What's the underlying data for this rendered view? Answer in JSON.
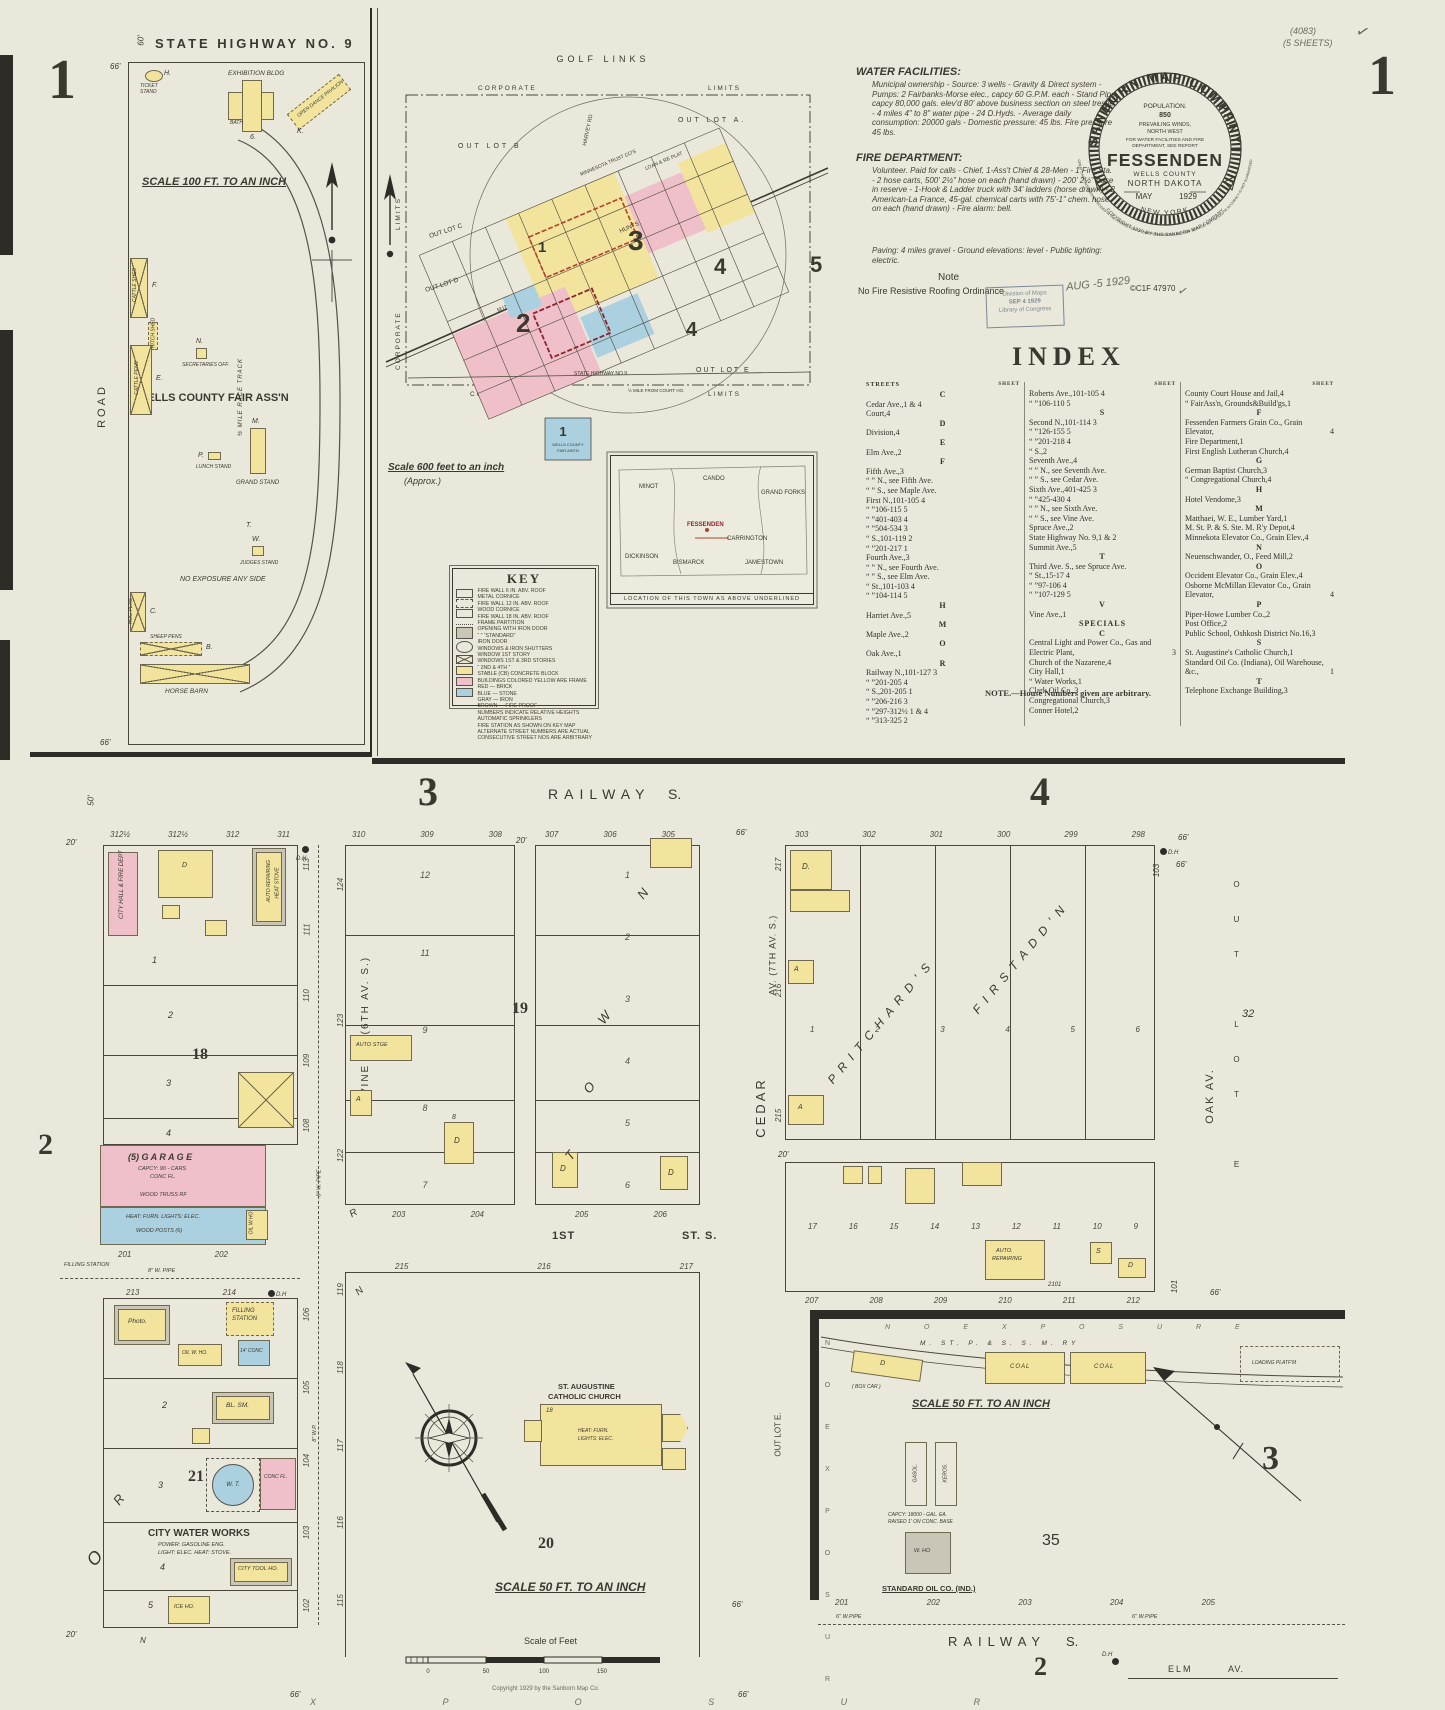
{
  "page": {
    "corner_left": "1",
    "corner_right": "1",
    "series": "(4083)",
    "sheets": "(5 SHEETS)",
    "check": "✓"
  },
  "report": {
    "water_title": "WATER FACILITIES:",
    "water_body": "Municipal ownership - Source: 3 wells - Gravity & Direct system - Pumps: 2 Fairbanks-Morse elec., capcy 60 G.P.M. each - Stand Pipe capcy 80,000 gals. elev'd 80' above business section on steel trestle - 4 miles 4\" to 8\" water pipe - 24 D.Hyds. - Average daily consumption: 20000 gals - Domestic pressure: 45 lbs. Fire pressure 45 lbs.",
    "fire_title": "FIRE DEPARTMENT:",
    "fire_body": "Volunteer. Paid for calls - Chief, 1-Ass't Chief & 28-Men - 1 Fire Sta. - 2 hose carts, 500' 2½\" hose on each (hand drawn) - 200' 2½\" hose in reserve - 1-Hook & Ladder truck with 34' ladders (horse drawn) - 2 American-La France, 45-gal. chemical carts with 75'-1\" chem. hose on each (hand drawn) - Fire alarm: bell.",
    "paving": "Paving: 4 miles gravel - Ground elevations: level - Public lighting: electric.",
    "note_title": "Note",
    "note_body": "No Fire Resistive Roofing Ordinance"
  },
  "seal": {
    "company": "SANBORN MAP COMPANY",
    "population": "POPULATION.",
    "pop_value": "850",
    "winds1": "PREVAILING WINDS,",
    "winds2": "NORTH WEST",
    "report1": "FOR WATER FACILITIES AND FIRE",
    "report2": "DEPARTMENT, SEE REPORT",
    "city": "FESSENDEN",
    "county": "WELLS COUNTY",
    "state": "NORTH DAKOTA",
    "month": "MAY",
    "year": "1929",
    "office": "NEW YORK",
    "copyright": "COPYRIGHT 1929 BY THE SANBORN MAP COMPANY",
    "disclaimer": "GREAT CARE HAS BEEN EXERCISED IN THE PRODUCTION OF OUR PUBLICATIONS AND OUR SERVICE, BUT ABSOLUTE ACCURACY IS NOT GUARANTEED"
  },
  "stamps": {
    "received": "AUG -5 1929",
    "loc1": "Division of Maps",
    "loc2": "SEP 4 1929",
    "loc3": "Library of Congress",
    "catalog": "©C1F  47970",
    "check": "✓"
  },
  "index": {
    "title": "INDEX",
    "streets": "STREETS",
    "sheet": "SHEET",
    "footnote": "NOTE.—House Numbers given are arbitrary.",
    "col1": [
      {
        "h": "C"
      },
      {
        "n": "Cedar Ave.,",
        "r": "1 & 4"
      },
      {
        "n": "Court,",
        "r": "4"
      },
      {
        "h": "D"
      },
      {
        "n": "Division,",
        "r": "4"
      },
      {
        "h": "E"
      },
      {
        "n": "Elm Ave.,",
        "r": "2"
      },
      {
        "h": "F"
      },
      {
        "n": "Fifth Ave.,",
        "r": "3"
      },
      {
        "n": "“ ” N., see Fifth Ave.",
        "r": ""
      },
      {
        "n": "“ ” S., see Maple Ave.",
        "r": ""
      },
      {
        "n": "First N.,",
        "r": "101-105 4"
      },
      {
        "n": "“  ”",
        "r": "106-115 5"
      },
      {
        "n": "“  ”",
        "r": "401-403 4"
      },
      {
        "n": "“  ”",
        "r": "504-534 3"
      },
      {
        "n": "“  S.,",
        "r": "101-119 2"
      },
      {
        "n": "“  ”",
        "r": "201-217 1"
      },
      {
        "n": "Fourth Ave.,",
        "r": "3"
      },
      {
        "n": "“ ” N., see Fourth Ave.",
        "r": ""
      },
      {
        "n": "“ ” S., see Elm Ave.",
        "r": ""
      },
      {
        "n": "“  St.,",
        "r": "101-103 4"
      },
      {
        "n": "“  ”",
        "r": "104-114 5"
      },
      {
        "h": "H"
      },
      {
        "n": "Harriet Ave.,",
        "r": "5"
      },
      {
        "h": "M"
      },
      {
        "n": "Maple Ave.,",
        "r": "2"
      },
      {
        "h": "O"
      },
      {
        "n": "Oak Ave.,",
        "r": "1"
      },
      {
        "h": "R"
      },
      {
        "n": "Railway N.,",
        "r": "101-127 3"
      },
      {
        "n": "“  ”",
        "r": "201-205 4"
      },
      {
        "n": "“  S.,",
        "r": "201-205 1"
      },
      {
        "n": "“  ”",
        "r": "206-216 3"
      },
      {
        "n": "“  ”",
        "r": "297-312½ 1 & 4"
      },
      {
        "n": "“  ”",
        "r": "313-325 2"
      }
    ],
    "col2": [
      {
        "n": "Roberts Ave.,",
        "r": "101-105 4"
      },
      {
        "n": "“  ”",
        "r": "106-110 5"
      },
      {
        "h": "S"
      },
      {
        "n": "Second N.,",
        "r": "101-114 3"
      },
      {
        "n": "“  ”",
        "r": "126-155 5"
      },
      {
        "n": "“  ”",
        "r": "201-218 4"
      },
      {
        "n": "“  S.,",
        "r": "2"
      },
      {
        "n": "Seventh Ave.,",
        "r": "4"
      },
      {
        "n": "“ ” N., see Seventh Ave.",
        "r": ""
      },
      {
        "n": "“ ” S., see Cedar Ave.",
        "r": ""
      },
      {
        "n": "Sixth Ave.,",
        "r": "401-425 3"
      },
      {
        "n": "“  ”",
        "r": "425-430 4"
      },
      {
        "n": "“ ” N., see Sixth Ave.",
        "r": ""
      },
      {
        "n": "“ ” S., see Vine Ave.",
        "r": ""
      },
      {
        "n": "Spruce Ave.,",
        "r": "2"
      },
      {
        "n": "State Highway No. 9,",
        "r": "1 & 2"
      },
      {
        "n": "Summit Ave.,",
        "r": "5"
      },
      {
        "h": "T"
      },
      {
        "n": "Third Ave. S., see Spruce Ave.",
        "r": ""
      },
      {
        "n": "“  St.,",
        "r": "15-17 4"
      },
      {
        "n": "“  ”",
        "r": "97-106 4"
      },
      {
        "n": "“  ”",
        "r": "107-129 5"
      },
      {
        "h": "V"
      },
      {
        "n": "Vine Ave.,",
        "r": "1"
      },
      {
        "h": "SPECIALS"
      },
      {
        "h": "C"
      },
      {
        "n": "Central Light and Power Co., Gas and Electric Plant,",
        "r": "3"
      },
      {
        "n": "Church of the Nazarene,",
        "r": "4"
      },
      {
        "n": "City Hall,",
        "r": "1"
      },
      {
        "n": "“  Water Works,",
        "r": "1"
      },
      {
        "n": "Clark Oil Co.,",
        "r": "3"
      },
      {
        "n": "Congregational Church,",
        "r": "3"
      },
      {
        "n": "Conner Hotel,",
        "r": "2"
      }
    ],
    "col3": [
      {
        "n": "County Court House and Jail,",
        "r": "4"
      },
      {
        "n": "“  FairAss'n, Grounds&Build'gs,",
        "r": "1"
      },
      {
        "h": "F"
      },
      {
        "n": "Fessenden Farmers Grain Co., Grain Elevator,",
        "r": "4"
      },
      {
        "n": "Fire Department,",
        "r": "1"
      },
      {
        "n": "First English Lutheran Church,",
        "r": "4"
      },
      {
        "h": "G"
      },
      {
        "n": "German Baptist Church,",
        "r": "3"
      },
      {
        "n": "“  Congregational Church,",
        "r": "4"
      },
      {
        "h": "H"
      },
      {
        "n": "Hotel Vendome,",
        "r": "3"
      },
      {
        "h": "M"
      },
      {
        "n": "Matthaei, W. E., Lumber Yard,",
        "r": "1"
      },
      {
        "n": "M. St. P. & S. Ste. M. R'y Depot,",
        "r": "4"
      },
      {
        "n": "Minnekota Elevator Co., Grain Elev.,",
        "r": "4"
      },
      {
        "h": "N"
      },
      {
        "n": "Neuenschwander, O., Feed Mill,",
        "r": "2"
      },
      {
        "h": "O"
      },
      {
        "n": "Occident Elevator Co., Grain Elev.,",
        "r": "4"
      },
      {
        "n": "Osborne McMillan Elevator Co., Grain Elevator,",
        "r": "4"
      },
      {
        "h": "P"
      },
      {
        "n": "Piper-Howe Lumber Co.,",
        "r": "2"
      },
      {
        "n": "Post Office,",
        "r": "2"
      },
      {
        "n": "Public School, Oshkosh District No.16,",
        "r": "3"
      },
      {
        "h": "S"
      },
      {
        "n": "St. Augustine's Catholic Church,",
        "r": "1"
      },
      {
        "n": "Standard Oil Co. (Indiana), Oil Warehouse, &c.,",
        "r": "1"
      },
      {
        "h": "T"
      },
      {
        "n": "Telephone Exchange Building,",
        "r": "3"
      }
    ]
  },
  "fair": {
    "highway": "STATE  HIGHWAY   NO. 9",
    "dim66": "66'",
    "dim66b": "66'",
    "dim60": "60'",
    "h": "H.",
    "ticket": "TICKET STAND",
    "exhibition": "EXHIBITION BLDG",
    "ex_num": "6.",
    "bath": "BATH",
    "pavilion": "OPEN DANCE PAVILION",
    "k": "K.",
    "scale": "SCALE 100 FT. TO AN INCH",
    "road": "ROAD",
    "name": "WELLS COUNTY FAIR ASS'N",
    "f": "F.",
    "cattle_shed": "CATTLE SHED",
    "hitch": "HITCH SHED",
    "e": "E.",
    "cattle_pens": "CATTLE PENS",
    "n": "N.",
    "secretaries": "SECRETARIES OFF.",
    "p": "P.",
    "lunch": "LUNCH STAND",
    "m": "M.",
    "grand": "GRAND STAND",
    "t": "T.",
    "w": "W.",
    "judges": "JUDGES STAND",
    "track": "½ MILE RACE TRACK",
    "no_exp": "NO EXPOSURE ANY SIDE",
    "c": "C.",
    "hog": "HOG PENS",
    "b": "B.",
    "sheep": "SHEEP PENS",
    "barn": "HORSE BARN"
  },
  "plat": {
    "golf": "GOLF  LINKS",
    "corp": "CORPORATE",
    "limits": "LIMITS",
    "corp2": "CORPORATE",
    "limits2": "LIMITS",
    "corp3": "CORPORATE",
    "limits3": "LIMITS",
    "out_a": "OUT  LOT  A.",
    "out_b": "OUT  LOT  B",
    "out_c": "OUT LOT C",
    "out_d": "OUT LOT D",
    "out_e": "OUT  LOT  E",
    "harvey": "HARVEY RD",
    "rr": "MINNEAPOLIS ST PAUL & SAULT STE MARIE RY",
    "hwy": "STATE HIGHWAY NO 9",
    "halfmile": "½ MILE FROM COURT HO.",
    "hunts": "HUNTS",
    "trust": "MINNESOTA TRUST CO'S",
    "loan": "LOAN & RE PLAT",
    "s1": "1",
    "s2": "2",
    "s3": "3",
    "s4": "4",
    "s4b": "4",
    "s5": "5",
    "fair_num": "1",
    "fair_label1": "WELLS COUNTY",
    "fair_label2": "FAIR ASS'N",
    "scale": "Scale 600  feet to an inch",
    "approx": "(Approx.)"
  },
  "key": {
    "title": "KEY",
    "lines": [
      "FIRE WALL 6 IN. ABV. ROOF",
      "METAL CORNICE",
      "FIRE WALL 12 IN. ABV. ROOF",
      "WOOD CORNICE",
      "FIRE WALL 18 IN. ABV. ROOF",
      "FRAME PARTITION",
      "OPENING WITH IRON DOOR",
      "“  ”  “STANDARD”",
      "IRON DOOR",
      "WINDOWS & IRON SHUTTERS",
      "WINDOW 1ST STORY",
      "WINDOWS 1ST & 3RD STORIES",
      "“  2ND & 4TH  ”",
      "STABLE   (CB) CONCRETE BLOCK",
      "BUILDINGS COLORED YELLOW ARE FRAME",
      "RED — BRICK",
      "BLUE — STONE",
      "GRAY — IRON",
      "BROWN — FIRE PROOF",
      "NUMBERS INDICATE RELATIVE HEIGHTS",
      "AUTOMATIC SPRINKLERS",
      "FIRE STATION AS SHOWN ON KEY MAP",
      "ALTERNATE STREET NUMBERS ARE ACTUAL",
      "CONSECUTIVE STREET NOS ARE ARBITRARY"
    ]
  },
  "inset": {
    "caption": "LOCATION OF THIS TOWN AS ABOVE UNDERLINED",
    "towns": [
      "MINOT",
      "CANDO",
      "GRAND FORKS",
      "FESSENDEN",
      "CARRINGTON",
      "JAMESTOWN",
      "BISMARCK",
      "DICKINSON"
    ]
  },
  "hdr": {
    "three": "3",
    "railway": "RAILWAY",
    "s": "S.",
    "four": "4",
    "d50": "50'",
    "d66": "66'",
    "d66b": "66'",
    "d20": "20'",
    "railway2": "RAILWAY",
    "s2": "S.",
    "two": "2",
    "elm": "ELM",
    "av": "AV.",
    "dh": "D.H",
    "three_r": "3"
  },
  "p2": {
    "two": "2",
    "lots_top": [
      "312½",
      "312½",
      "312",
      "311"
    ],
    "dh": "D.H",
    "d20": "20'",
    "rmargin": [
      "113",
      "111",
      "110",
      "109",
      "108"
    ],
    "pipe8": "8\" W. PIPE",
    "pipe8b": "8\" W.P.",
    "city_hall": "CITY HALL & FIRE DEPT",
    "d": "D",
    "r1": "1",
    "r2": "2",
    "r3": "3",
    "r4": "4",
    "blknum": "18",
    "auto1": "AUTO REPAIRING",
    "auto1b": "HEAT STOVE",
    "garage_t": "(5)  G A R A G E",
    "garage_1": "CAPCY: 90 - CARS",
    "garage_2": "CONC FL.",
    "garage_3": "WOOD  TRUSS  RF",
    "garage_4": "HEAT: FURN.  LIGHTS: ELEC.",
    "garage_5": "WOOD  POSTS  (6)",
    "oilwho": "OIL W.HO",
    "lots_g": [
      "201",
      "202"
    ],
    "filling1": "FILLING STATION",
    "pipe_lbl": "8\" W. PIPE",
    "vine": "VINE   AV.   (6TH   AV.  S.)",
    "lots_21top": [
      "213",
      "214"
    ],
    "dh2": "D.H",
    "photo": "Photo.",
    "filling2": "FILLING",
    "filling2b": "STATION",
    "oilwho2": "OIL W. HO.",
    "conc14": "14' CONC",
    "blsm": "BL. SM.",
    "b2": "2",
    "b3": "3",
    "blknum2": "21",
    "wt": "W. T.",
    "concfl": "CONC FL.",
    "cww": "CITY  WATER  WORKS",
    "cww1": "POWER: GASOLINE ENG.",
    "cww2": "LIGHT: ELEC. HEAT: STOVE.",
    "b4": "4",
    "toolho": "CITY TOOL HO.",
    "b5": "5",
    "iceho": "ICE HO.",
    "n": "N",
    "d20b": "20'",
    "rmargin2": [
      "106",
      "105",
      "104",
      "103",
      "102"
    ],
    "rdiag": "R",
    "odiag": "O"
  },
  "p19": {
    "lots_topL": [
      "310",
      "309",
      "308"
    ],
    "lots_topR": [
      "307",
      "306",
      "305"
    ],
    "d20": "20'",
    "lmargin": [
      "124",
      "123",
      "122"
    ],
    "rowsL": [
      "12",
      "11",
      "9",
      "8",
      "7"
    ],
    "rowsR": [
      "1",
      "2",
      "3",
      "4",
      "5",
      "6"
    ],
    "blknum": "19",
    "auto": "AUTO STGE",
    "a": "A",
    "d1": "D",
    "e8": "8",
    "d2": "D",
    "d3": "D",
    "town": [
      "T",
      "O",
      "W",
      "N"
    ],
    "lots_botL": [
      "203",
      "204"
    ],
    "lots_botR": [
      "205",
      "206"
    ],
    "r": "R",
    "first": "1ST",
    "st_s": "ST.  S."
  },
  "p20": {
    "lots_top": [
      "215",
      "216",
      "217"
    ],
    "lmargin": [
      "119",
      "118",
      "117",
      "116",
      "115"
    ],
    "n": "N",
    "church1": "ST. AUGUSTINE",
    "church2": "CATHOLIC CHURCH",
    "ch18": "18",
    "heat": "HEAT: FURN.",
    "lights": "LIGHTS: ELEC.",
    "blknum": "20",
    "scale": "SCALE 50 FT. TO AN INCH",
    "sof": "Scale of Feet",
    "bar": [
      "0",
      "50",
      "100",
      "150"
    ],
    "copyright": "Copyright 1929 by the Sanborn Map Co.",
    "exposure": "X   P   O   S   U   R",
    "d66": "66'",
    "d66b": "66'"
  },
  "p4": {
    "cedar": "CEDAR",
    "av7": "AV.  (7TH  AV.  S.)",
    "d66": "66'",
    "d66b": "66'",
    "lots_top": [
      "303",
      "302",
      "301",
      "300",
      "299",
      "298"
    ],
    "lmargin": [
      "217",
      "216",
      "215"
    ],
    "d20": "20'",
    "cells": [
      "1",
      "2",
      "3",
      "4",
      "5",
      "6"
    ],
    "pritchards": "P R I T C H A R D ' S",
    "firstaddn": "F I R S T   A D D ' N",
    "d": "D.",
    "a1": "A",
    "a2": "A",
    "row2": [
      "17",
      "16",
      "15",
      "14",
      "13",
      "12",
      "11",
      "10",
      "9"
    ],
    "auto": "AUTO.",
    "auto2": "REPAIRING",
    "n2101": "2101",
    "s": "S",
    "d2": "D",
    "lots_bot": [
      "207",
      "208",
      "209",
      "210",
      "211",
      "212"
    ],
    "oak": "OAK  AV.",
    "n32": "32",
    "outlote": "OUT LOT E",
    "n103": "103",
    "n101": "101",
    "dh": "D.H"
  },
  "yard": {
    "noexp": "N O      E X P O S U R E",
    "rr": "M.  ST.  P.  &  S.  S.  M.  RY",
    "coal1": "COAL",
    "coal2": "COAL",
    "loading1": "LOADING  PLATF'M",
    "boxcar_d": "D",
    "boxcar": "( BOX  CAR )",
    "scale": "SCALE 50 FT. TO AN INCH",
    "gasol": "GASOL.",
    "keros": "KEROS.",
    "cap1": "CAPCY: 18000 - GAL. EA.",
    "cap2": "RAISED 1' ON CONC. BASE",
    "who": "W. HO",
    "stdoil": "STANDARD  OIL  CO.  (IND.)",
    "n35": "35",
    "outlote": "OUT LOT E.",
    "exposure": "N O   E X P O S U R E",
    "lots": [
      "201",
      "202",
      "203",
      "204",
      "205"
    ],
    "pipe6": "6\" W.PIPE",
    "pipe6b": "6\" W.PIPE",
    "d66": "66'"
  }
}
